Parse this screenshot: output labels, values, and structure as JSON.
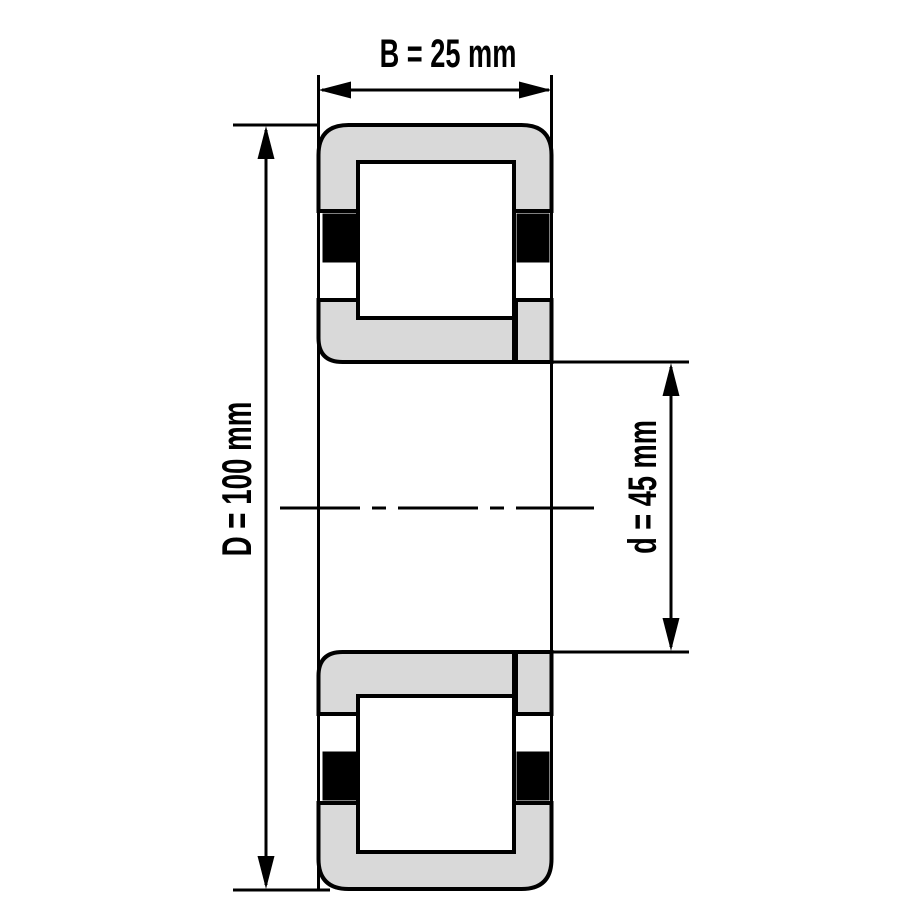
{
  "diagram": {
    "colors": {
      "background": "#ffffff",
      "line": "#000000",
      "ring_fill": "#d9d9d9",
      "roller_fill": "#ffffff",
      "cage_fill": "#000000"
    },
    "dimensions": {
      "width": {
        "label": "B = 25 mm",
        "value": 25,
        "unit": "mm"
      },
      "outer_diameter": {
        "label": "D = 100 mm",
        "value": 100,
        "unit": "mm"
      },
      "bore_diameter": {
        "label": "d = 45 mm",
        "value": 45,
        "unit": "mm"
      }
    }
  }
}
